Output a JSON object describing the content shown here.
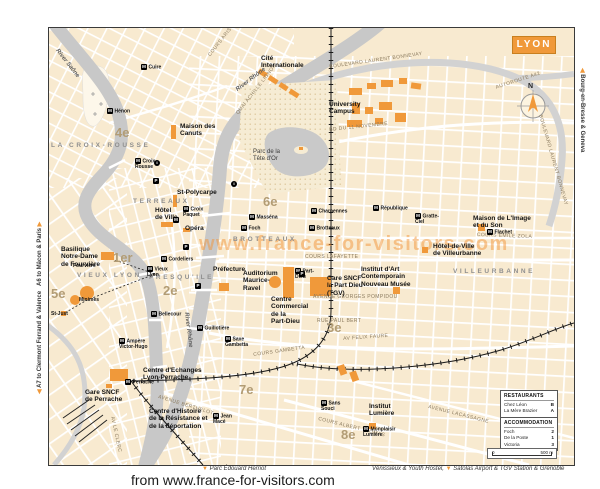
{
  "page": {
    "attribution": "from www.france-for-visitors.com"
  },
  "edges": {
    "a6": "A6 to Mâcon & Paris",
    "a7": "A7 to Clermont Ferrand & Valence",
    "bourg": "Bourg-en-Bresse & Geneva",
    "parc_herriot": "Parc Édouard Herriot",
    "venissieux": "Vénissieux & Youth Hostel,",
    "satolas": "Satolas Airport & TGV Station & Grenoble"
  },
  "legend": {
    "restaurants": {
      "title": "RESTAURANTS",
      "items": [
        {
          "name": "Chez Léon",
          "key": "B"
        },
        {
          "name": "La Mère Brazier",
          "key": "A"
        }
      ]
    },
    "accommodation": {
      "title": "ACCOMMODATION",
      "items": [
        {
          "name": "Foch",
          "key": "2"
        },
        {
          "name": "De la Poste",
          "key": "1"
        },
        {
          "name": "Victoria",
          "key": "3"
        }
      ]
    },
    "scale": {
      "start": "0",
      "end": "500 m"
    }
  },
  "map": {
    "title": "LYON",
    "watermark": "www.france-for-visitors.com",
    "compass_north": "N",
    "colors": {
      "accent_orange": "#F0993A",
      "river_gray": "#C8C8C8",
      "land_cream": "#F8EAD0"
    },
    "icons": {
      "metro": "M",
      "parking": "P",
      "info": "i"
    },
    "labels": [
      {
        "id": "district-4e",
        "cls": "district",
        "text": "4e",
        "x": 66,
        "y": 97
      },
      {
        "id": "district-1er",
        "cls": "district",
        "text": "1er",
        "x": 64,
        "y": 222
      },
      {
        "id": "district-5e",
        "cls": "district",
        "text": "5e",
        "x": 2,
        "y": 258
      },
      {
        "id": "district-2e",
        "cls": "district",
        "text": "2e",
        "x": 114,
        "y": 255
      },
      {
        "id": "district-6e",
        "cls": "district",
        "text": "6e",
        "x": 214,
        "y": 166
      },
      {
        "id": "district-3e",
        "cls": "district",
        "text": "3e",
        "x": 278,
        "y": 292
      },
      {
        "id": "district-7e",
        "cls": "district",
        "text": "7e",
        "x": 190,
        "y": 354
      },
      {
        "id": "district-8e",
        "cls": "district",
        "text": "8e",
        "x": 292,
        "y": 399
      },
      {
        "id": "area-la-croix-rousse",
        "cls": "area",
        "text": "LA CROIX-ROUSSE",
        "x": 2,
        "y": 114
      },
      {
        "id": "area-terreaux",
        "cls": "area",
        "text": "TERREAUX",
        "x": 84,
        "y": 170
      },
      {
        "id": "area-vieux-lyon",
        "cls": "area",
        "text": "VIEUX LYON",
        "x": 28,
        "y": 244
      },
      {
        "id": "area-presquile",
        "cls": "area",
        "text": "PRESQU'ILE",
        "x": 100,
        "y": 246
      },
      {
        "id": "area-brotteaux",
        "cls": "area",
        "text": "BROTTEAUX",
        "x": 184,
        "y": 208
      },
      {
        "id": "area-villeurbanne",
        "cls": "area",
        "text": "VILLEURBANNE",
        "x": 404,
        "y": 240
      },
      {
        "id": "river-saone-label",
        "cls": "river",
        "text": "River Saône",
        "x": 10,
        "y": 20,
        "rot": 52
      },
      {
        "id": "river-rhone-label-top",
        "cls": "river",
        "text": "River Rhône",
        "x": 186,
        "y": 60,
        "rot": -37
      },
      {
        "id": "river-rhone-label-mid",
        "cls": "river",
        "text": "River Rhône",
        "x": 140,
        "y": 284,
        "rot": 83
      },
      {
        "id": "street-bonnevay-top",
        "cls": "street",
        "text": "BOULEVARD LAURENT BONNEVAY",
        "x": 280,
        "y": 36,
        "rot": -8
      },
      {
        "id": "street-bonnevay-right",
        "cls": "street",
        "text": "BOULEVARD LAURENT BONNEVAY",
        "x": 494,
        "y": 86,
        "rot": 74
      },
      {
        "id": "street-autoroute-a42",
        "cls": "street",
        "text": "AUTOROUTE A42",
        "x": 446,
        "y": 57,
        "rot": -18
      },
      {
        "id": "street-cours-aristide-briand",
        "cls": "street",
        "text": "COURS ARISTIDE BRIAND",
        "x": 158,
        "y": 26,
        "rot": -52
      },
      {
        "id": "street-quai-achille-lignon",
        "cls": "street",
        "text": "QUAI ACHILLE LIGNON",
        "x": 186,
        "y": 84,
        "rot": -52
      },
      {
        "id": "street-bd-11-novembre",
        "cls": "street",
        "text": "BD DU 11 NOVEMBRE",
        "x": 280,
        "y": 99,
        "rot": -6
      },
      {
        "id": "street-cours-emile-zola",
        "cls": "street",
        "text": "COURS EMILE ZOLA",
        "x": 428,
        "y": 204,
        "rot": 2
      },
      {
        "id": "street-cours-lafayette",
        "cls": "street",
        "text": "COURS LAFAYETTE",
        "x": 256,
        "y": 226
      },
      {
        "id": "street-av-georges-pompidou",
        "cls": "street",
        "text": "AVENUE GEORGES POMPIDOU",
        "x": 264,
        "y": 266
      },
      {
        "id": "street-rue-paul-bert",
        "cls": "street",
        "text": "RUE PAUL BERT",
        "x": 268,
        "y": 290
      },
      {
        "id": "street-av-felix-faure",
        "cls": "street",
        "text": "AV FELIX FAURE",
        "x": 294,
        "y": 308,
        "rot": -4
      },
      {
        "id": "street-cours-gambetta",
        "cls": "street",
        "text": "COURS GAMBETTA",
        "x": 204,
        "y": 324,
        "rot": -8
      },
      {
        "id": "street-avenue-berthelot",
        "cls": "street",
        "text": "AVENUE BERTHELOT",
        "x": 110,
        "y": 366,
        "rot": 17
      },
      {
        "id": "street-av-le-clerc",
        "cls": "street",
        "text": "AV LE CLERC",
        "x": 66,
        "y": 388,
        "rot": 78
      },
      {
        "id": "street-cours-albert-thomas",
        "cls": "street",
        "text": "COURS ALBERT THOMAS",
        "x": 270,
        "y": 388,
        "rot": 14
      },
      {
        "id": "street-avenue-lacassagne",
        "cls": "street",
        "text": "AVENUE LACASSAGNE",
        "x": 380,
        "y": 376,
        "rot": 14
      },
      {
        "id": "poi-cite-internationale",
        "cls": "poi",
        "text": "Cité\nInternationale",
        "x": 212,
        "y": 27
      },
      {
        "id": "poi-maison-des-canuts",
        "cls": "poi",
        "text": "Maison des\nCanuts",
        "x": 131,
        "y": 95
      },
      {
        "id": "poi-university-campus",
        "cls": "poi",
        "text": "University\nCampus",
        "x": 280,
        "y": 73
      },
      {
        "id": "poi-parc-tete-dor",
        "cls": "park-label",
        "text": "Parc de la\nTête d'Or",
        "x": 204,
        "y": 121
      },
      {
        "id": "poi-maison-image-son",
        "cls": "poi",
        "text": "Maison de L'Image\net du Son",
        "x": 424,
        "y": 187
      },
      {
        "id": "poi-hdv-villeurbanne",
        "cls": "poi",
        "text": "Hôtel-de-Ville\nde Villeurbanne",
        "x": 384,
        "y": 215
      },
      {
        "id": "poi-institut-art",
        "cls": "poi",
        "text": "Institut d'Art\nContemporain\nNouveau Musée",
        "x": 312,
        "y": 238
      },
      {
        "id": "poi-gare-part-dieu",
        "cls": "poi",
        "text": "Gare SNCF\nla Part Dieu\n(TGV)",
        "x": 278,
        "y": 247
      },
      {
        "id": "poi-cc-part-dieu",
        "cls": "poi",
        "text": "Centre\nCommercial\nde la\nPart-Dieu",
        "x": 222,
        "y": 268
      },
      {
        "id": "poi-auditorium",
        "cls": "poi",
        "text": "Auditorium\nMaurice-\nRavel",
        "x": 194,
        "y": 242
      },
      {
        "id": "poi-prefecture",
        "cls": "poi",
        "text": "Préfecture",
        "x": 164,
        "y": 238
      },
      {
        "id": "poi-st-polycarpe",
        "cls": "poi",
        "text": "St-Polycarpe",
        "x": 128,
        "y": 161
      },
      {
        "id": "poi-hotel-de-ville",
        "cls": "poi",
        "text": "Hôtel\nde Ville",
        "x": 106,
        "y": 179
      },
      {
        "id": "poi-opera",
        "cls": "poi",
        "text": "Opéra",
        "x": 136,
        "y": 197
      },
      {
        "id": "poi-basilique",
        "cls": "poi",
        "text": "Basilique\nNotre-Dame\nde Fourvière",
        "x": 12,
        "y": 218
      },
      {
        "id": "poi-centre-echanges",
        "cls": "poi",
        "text": "Centre d'Echanges\nLyon-Perrache",
        "x": 94,
        "y": 339
      },
      {
        "id": "poi-gare-perrache",
        "cls": "poi",
        "text": "Gare SNCF\nde Perrache",
        "x": 36,
        "y": 361
      },
      {
        "id": "poi-centre-histoire",
        "cls": "poi",
        "text": "Centre d'Histoire\nde la Résistance et\nde la déportation",
        "x": 100,
        "y": 380
      },
      {
        "id": "poi-institut-lumiere",
        "cls": "poi",
        "text": "Institut\nLumière",
        "x": 320,
        "y": 375
      },
      {
        "id": "station-cuire",
        "cls": "station",
        "icon": "metro",
        "text": "Cuire",
        "x": 92,
        "y": 36
      },
      {
        "id": "station-henon",
        "cls": "station",
        "icon": "metro",
        "text": "Hénon",
        "x": 58,
        "y": 80
      },
      {
        "id": "station-croix-rousse",
        "cls": "station",
        "icon": "metro",
        "text": "Croix\nRousse",
        "x": 86,
        "y": 130
      },
      {
        "id": "station-croix-paquet",
        "cls": "station",
        "icon": "metro",
        "text": "Croix\nPaquet",
        "x": 134,
        "y": 178
      },
      {
        "id": "station-hotel-de-ville-metro",
        "cls": "station",
        "icon": "metro",
        "text": "",
        "x": 124,
        "y": 189
      },
      {
        "id": "station-fourviere",
        "cls": "station",
        "text": "Fourvière",
        "x": 24,
        "y": 235
      },
      {
        "id": "station-vieux-lyon",
        "cls": "station",
        "icon": "metro",
        "text": "Vieux\nLyon",
        "x": 98,
        "y": 238
      },
      {
        "id": "station-cordeliers",
        "cls": "station",
        "icon": "metro",
        "text": "Cordeliers",
        "x": 112,
        "y": 228
      },
      {
        "id": "station-minimes",
        "cls": "station",
        "text": "Minimes",
        "x": 30,
        "y": 269
      },
      {
        "id": "station-st-just",
        "cls": "station",
        "text": "St-Just",
        "x": 2,
        "y": 283
      },
      {
        "id": "station-bellecour",
        "cls": "station",
        "icon": "metro",
        "text": "Bellecour",
        "x": 102,
        "y": 283
      },
      {
        "id": "station-ampere",
        "cls": "station",
        "icon": "metro",
        "text": "Ampère\nVictor-Hugo",
        "x": 70,
        "y": 310
      },
      {
        "id": "station-perrache",
        "cls": "station",
        "icon": "metro",
        "text": "Perrache",
        "x": 76,
        "y": 351
      },
      {
        "id": "station-guillotiere",
        "cls": "station",
        "icon": "metro",
        "text": "Guillotière",
        "x": 148,
        "y": 297
      },
      {
        "id": "station-saxe-gambetta",
        "cls": "station",
        "icon": "metro",
        "text": "Saxe\nGambetta",
        "x": 176,
        "y": 308
      },
      {
        "id": "station-jean-mace",
        "cls": "station",
        "icon": "metro",
        "text": "Jean\nMacé",
        "x": 164,
        "y": 385
      },
      {
        "id": "station-charpennes",
        "cls": "station",
        "icon": "metro",
        "text": "Charpennes",
        "x": 262,
        "y": 180
      },
      {
        "id": "station-republique",
        "cls": "station",
        "icon": "metro",
        "text": "République",
        "x": 324,
        "y": 177
      },
      {
        "id": "station-gratte-ciel",
        "cls": "station",
        "icon": "metro",
        "text": "Gratte-\nCiel",
        "x": 366,
        "y": 185
      },
      {
        "id": "station-flachet",
        "cls": "station",
        "icon": "metro",
        "text": "Flachet",
        "x": 438,
        "y": 201
      },
      {
        "id": "station-massena",
        "cls": "station",
        "icon": "metro",
        "text": "Masséna",
        "x": 200,
        "y": 186
      },
      {
        "id": "station-foch",
        "cls": "station",
        "icon": "metro",
        "text": "Foch",
        "x": 192,
        "y": 197
      },
      {
        "id": "station-brotteaux",
        "cls": "station",
        "icon": "metro",
        "text": "Brotteaux",
        "x": 260,
        "y": 197
      },
      {
        "id": "station-part-dieu",
        "cls": "station",
        "icon": "metro",
        "text": "Part-\nDieu",
        "x": 246,
        "y": 240
      },
      {
        "id": "station-monplaisir-lumiere",
        "cls": "station",
        "icon": "metro",
        "text": "Monplaisir\nLumière",
        "x": 314,
        "y": 398
      },
      {
        "id": "station-sans-souci",
        "cls": "station",
        "icon": "metro",
        "text": "Sans\nSouci",
        "x": 272,
        "y": 372
      },
      {
        "id": "parking-terreaux",
        "cls": "station",
        "icon": "parking",
        "text": "",
        "x": 104,
        "y": 150
      },
      {
        "id": "parking-cordeliers",
        "cls": "station",
        "icon": "parking",
        "text": "",
        "x": 134,
        "y": 216
      },
      {
        "id": "parking-bellecour",
        "cls": "station",
        "icon": "parking",
        "text": "",
        "x": 146,
        "y": 255
      },
      {
        "id": "parking-brotteaux",
        "cls": "station",
        "icon": "parking",
        "text": "",
        "x": 250,
        "y": 243
      },
      {
        "id": "info-croix-rousse",
        "cls": "station",
        "icon": "info",
        "text": "",
        "x": 105,
        "y": 132
      },
      {
        "id": "info-terreaux",
        "cls": "station",
        "icon": "info",
        "text": "",
        "x": 182,
        "y": 153
      }
    ]
  }
}
